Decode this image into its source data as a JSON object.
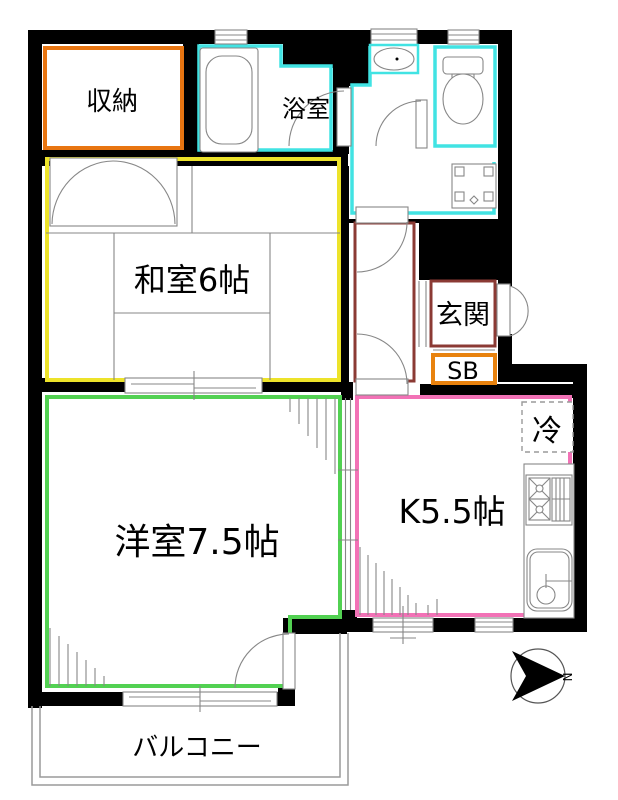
{
  "plan": {
    "type": "apartment-floor-plan",
    "compass": {
      "north_label": "N"
    }
  },
  "rooms": {
    "storage": {
      "label": "収納"
    },
    "bathroom": {
      "label": "浴室"
    },
    "japanese_room": {
      "label": "和室6帖"
    },
    "entrance": {
      "label": "玄関"
    },
    "shoe_box": {
      "label": "SB"
    },
    "refrigerator": {
      "label": "冷"
    },
    "kitchen": {
      "label": "K5.5帖"
    },
    "western_room": {
      "label": "洋室7.5帖"
    },
    "balcony": {
      "label": "バルコニー"
    }
  },
  "colors": {
    "wall": "#000000",
    "storage_border": "#e87511",
    "water_border": "#41e3e3",
    "japanese_border": "#ede32a",
    "hallway_border": "#8b3a34",
    "shoebox_border": "#e8820e",
    "kitchen_border": "#f272b6",
    "western_border": "#52d152",
    "fixture_line": "#878787",
    "balcony_line": "#9a9a9a"
  }
}
